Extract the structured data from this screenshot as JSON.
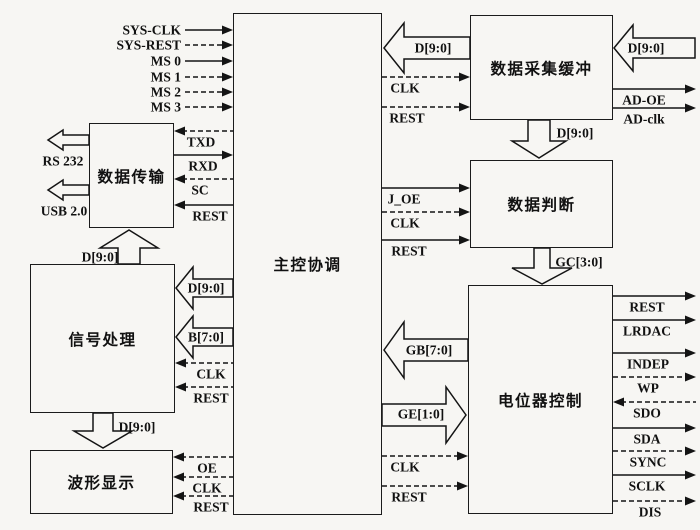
{
  "diagram": {
    "blocks": [
      {
        "id": "main-control",
        "label": "主控协调",
        "x": 233,
        "y": 13,
        "w": 149,
        "h": 502
      },
      {
        "id": "data-transfer",
        "label": "数据传输",
        "x": 89,
        "y": 123,
        "w": 85,
        "h": 105
      },
      {
        "id": "signal-processing",
        "label": "信号处理",
        "x": 30,
        "y": 264,
        "w": 145,
        "h": 149
      },
      {
        "id": "waveform-display",
        "label": "波形显示",
        "x": 30,
        "y": 450,
        "w": 143,
        "h": 64
      },
      {
        "id": "daq-buffer",
        "label": "数据采集缓冲",
        "x": 470,
        "y": 15,
        "w": 143,
        "h": 105
      },
      {
        "id": "data-judge",
        "label": "数据判断",
        "x": 470,
        "y": 160,
        "w": 143,
        "h": 88
      },
      {
        "id": "pot-control",
        "label": "电位器控制",
        "x": 468,
        "y": 285,
        "w": 145,
        "h": 229
      }
    ],
    "signals": [
      {
        "id": "sys-clk",
        "label": "SYS-CLK",
        "x1": 185,
        "x2": 233,
        "y": 30,
        "dash": false,
        "arrow": "right",
        "lx": 181,
        "ly": 30,
        "anchor": "end"
      },
      {
        "id": "sys-rest",
        "label": "SYS-REST",
        "x1": 185,
        "x2": 233,
        "y": 45,
        "dash": true,
        "arrow": "right",
        "lx": 181,
        "ly": 45,
        "anchor": "end"
      },
      {
        "id": "ms0",
        "label": "MS 0",
        "x1": 185,
        "x2": 233,
        "y": 61,
        "dash": false,
        "arrow": "right",
        "lx": 181,
        "ly": 61,
        "anchor": "end"
      },
      {
        "id": "ms1",
        "label": "MS 1",
        "x1": 185,
        "x2": 233,
        "y": 77,
        "dash": true,
        "arrow": "right",
        "lx": 181,
        "ly": 77,
        "anchor": "end"
      },
      {
        "id": "ms2",
        "label": "MS 2",
        "x1": 185,
        "x2": 233,
        "y": 92,
        "dash": true,
        "arrow": "right",
        "lx": 181,
        "ly": 92,
        "anchor": "end"
      },
      {
        "id": "ms3",
        "label": "MS 3",
        "x1": 185,
        "x2": 233,
        "y": 107,
        "dash": true,
        "arrow": "right",
        "lx": 181,
        "ly": 107,
        "anchor": "end"
      },
      {
        "id": "txd",
        "label": "TXD",
        "x1": 174,
        "x2": 233,
        "y": 131,
        "dash": true,
        "arrow": "left",
        "lx": 201,
        "ly": 142,
        "anchor": "mid"
      },
      {
        "id": "rxd",
        "label": "RXD",
        "x1": 174,
        "x2": 233,
        "y": 155,
        "dash": false,
        "arrow": "right",
        "lx": 203,
        "ly": 166,
        "anchor": "mid"
      },
      {
        "id": "sc",
        "label": "SC",
        "x1": 174,
        "x2": 233,
        "y": 179,
        "dash": true,
        "arrow": "left",
        "lx": 200,
        "ly": 190,
        "anchor": "mid"
      },
      {
        "id": "dt-rest",
        "label": "REST",
        "x1": 174,
        "x2": 233,
        "y": 205,
        "dash": false,
        "arrow": "left",
        "lx": 210,
        "ly": 216,
        "anchor": "mid"
      },
      {
        "id": "sp-clk",
        "label": "CLK",
        "x1": 175,
        "x2": 233,
        "y": 363,
        "dash": true,
        "arrow": "left",
        "lx": 211,
        "ly": 374,
        "anchor": "mid"
      },
      {
        "id": "sp-rest",
        "label": "REST",
        "x1": 175,
        "x2": 233,
        "y": 387,
        "dash": true,
        "arrow": "left",
        "lx": 211,
        "ly": 398,
        "anchor": "mid"
      },
      {
        "id": "wf-oe",
        "label": "OE",
        "x1": 173,
        "x2": 233,
        "y": 457,
        "dash": true,
        "arrow": "left",
        "lx": 207,
        "ly": 468,
        "anchor": "mid"
      },
      {
        "id": "wf-clk",
        "label": "CLK",
        "x1": 173,
        "x2": 233,
        "y": 477,
        "dash": true,
        "arrow": "left",
        "lx": 207,
        "ly": 488,
        "anchor": "mid"
      },
      {
        "id": "wf-rest",
        "label": "REST",
        "x1": 173,
        "x2": 233,
        "y": 496,
        "dash": true,
        "arrow": "left",
        "lx": 211,
        "ly": 507,
        "anchor": "mid"
      },
      {
        "id": "daq-clk",
        "label": "CLK",
        "x1": 382,
        "x2": 470,
        "y": 77,
        "dash": true,
        "arrow": "right",
        "lx": 405,
        "ly": 88,
        "anchor": "mid"
      },
      {
        "id": "daq-rest",
        "label": "REST",
        "x1": 382,
        "x2": 470,
        "y": 107,
        "dash": true,
        "arrow": "right",
        "lx": 407,
        "ly": 118,
        "anchor": "mid"
      },
      {
        "id": "judge-joe",
        "label": "J_OE",
        "x1": 382,
        "x2": 470,
        "y": 188,
        "dash": false,
        "arrow": "right",
        "lx": 404,
        "ly": 199,
        "anchor": "mid"
      },
      {
        "id": "judge-clk",
        "label": "CLK",
        "x1": 382,
        "x2": 470,
        "y": 212,
        "dash": true,
        "arrow": "right",
        "lx": 405,
        "ly": 223,
        "anchor": "mid"
      },
      {
        "id": "judge-rest",
        "label": "REST",
        "x1": 382,
        "x2": 470,
        "y": 240,
        "dash": false,
        "arrow": "right",
        "lx": 409,
        "ly": 251,
        "anchor": "mid"
      },
      {
        "id": "pot-clk",
        "label": "CLK",
        "x1": 382,
        "x2": 468,
        "y": 456,
        "dash": true,
        "arrow": "right",
        "lx": 405,
        "ly": 467,
        "anchor": "mid"
      },
      {
        "id": "pot-rest",
        "label": "REST",
        "x1": 382,
        "x2": 468,
        "y": 486,
        "dash": true,
        "arrow": "right",
        "lx": 409,
        "ly": 497,
        "anchor": "mid"
      },
      {
        "id": "ad-oe",
        "label": "AD-OE",
        "x1": 613,
        "x2": 696,
        "y": 89,
        "dash": false,
        "arrow": "right",
        "lx": 644,
        "ly": 100,
        "anchor": "mid"
      },
      {
        "id": "ad-clk",
        "label": "AD-clk",
        "x1": 613,
        "x2": 696,
        "y": 108,
        "dash": false,
        "arrow": "right",
        "lx": 644,
        "ly": 119,
        "anchor": "mid"
      },
      {
        "id": "pot-rest-out",
        "label": "REST",
        "x1": 613,
        "x2": 696,
        "y": 296,
        "dash": false,
        "arrow": "right",
        "lx": 647,
        "ly": 307,
        "anchor": "mid"
      },
      {
        "id": "pot-lrdac",
        "label": "LRDAC",
        "x1": 613,
        "x2": 696,
        "y": 320,
        "dash": false,
        "arrow": "right",
        "lx": 647,
        "ly": 331,
        "anchor": "mid"
      },
      {
        "id": "pot-indep",
        "label": "INDEP",
        "x1": 613,
        "x2": 696,
        "y": 353,
        "dash": false,
        "arrow": "right",
        "lx": 648,
        "ly": 364,
        "anchor": "mid"
      },
      {
        "id": "pot-wp",
        "label": "WP",
        "x1": 613,
        "x2": 696,
        "y": 377,
        "dash": true,
        "arrow": "right",
        "lx": 648,
        "ly": 388,
        "anchor": "mid"
      },
      {
        "id": "pot-sdo",
        "label": "SDO",
        "x1": 613,
        "x2": 696,
        "y": 402,
        "dash": true,
        "arrow": "left",
        "lx": 647,
        "ly": 413,
        "anchor": "mid"
      },
      {
        "id": "pot-sda",
        "label": "SDA",
        "x1": 613,
        "x2": 696,
        "y": 428,
        "dash": false,
        "arrow": "right",
        "lx": 647,
        "ly": 439,
        "anchor": "mid"
      },
      {
        "id": "pot-sync",
        "label": "SYNC",
        "x1": 613,
        "x2": 696,
        "y": 451,
        "dash": true,
        "arrow": "right",
        "lx": 648,
        "ly": 462,
        "anchor": "mid"
      },
      {
        "id": "pot-sclk",
        "label": "SCLK",
        "x1": 613,
        "x2": 696,
        "y": 475,
        "dash": false,
        "arrow": "right",
        "lx": 647,
        "ly": 486,
        "anchor": "mid"
      },
      {
        "id": "pot-dis",
        "label": "DIS",
        "x1": 613,
        "x2": 696,
        "y": 501,
        "dash": true,
        "arrow": "right",
        "lx": 650,
        "ly": 512,
        "anchor": "mid"
      }
    ],
    "hollow_arrows": [
      {
        "id": "rs232-out",
        "dir": "left",
        "tip": [
          48,
          140
        ],
        "head_len": 15,
        "half_head": 10,
        "half_shaft": 5,
        "shaft_len": 26,
        "label": "RS 232",
        "label_at": [
          63,
          161
        ]
      },
      {
        "id": "usb-out",
        "dir": "left",
        "tip": [
          48,
          190
        ],
        "head_len": 15,
        "half_head": 10,
        "half_shaft": 5,
        "shaft_len": 26,
        "label": "USB 2.0",
        "label_at": [
          64,
          211
        ]
      },
      {
        "id": "dt-d-up",
        "dir": "up",
        "tip": [
          129,
          230
        ],
        "head_len": 18,
        "half_head": 29,
        "half_shaft": 11,
        "shaft_len": 16,
        "label": "D[9:0]",
        "label_at": [
          100,
          257
        ]
      },
      {
        "id": "sp-d-in",
        "dir": "left",
        "tip": [
          176,
          288
        ],
        "head_len": 17,
        "half_head": 21,
        "half_shaft": 9,
        "shaft_len": 40,
        "label": "D[9:0]",
        "label_at": [
          206,
          288
        ]
      },
      {
        "id": "sp-b-in",
        "dir": "left",
        "tip": [
          176,
          337
        ],
        "head_len": 17,
        "half_head": 21,
        "half_shaft": 9,
        "shaft_len": 40,
        "label": "B[7:0]",
        "label_at": [
          206,
          337
        ]
      },
      {
        "id": "mc-d-in",
        "dir": "left",
        "tip": [
          384,
          48
        ],
        "head_len": 20,
        "half_head": 25,
        "half_shaft": 11,
        "shaft_len": 66,
        "label": "D[9:0]",
        "label_at": [
          433,
          48
        ]
      },
      {
        "id": "adc-d-in",
        "dir": "left",
        "tip": [
          614,
          48
        ],
        "head_len": 19,
        "half_head": 23,
        "half_shaft": 10,
        "shaft_len": 62,
        "label": "D[9:0]",
        "label_at": [
          646,
          48
        ]
      },
      {
        "id": "judge-d-down",
        "dir": "down",
        "tip": [
          539,
          158
        ],
        "head_len": 17,
        "half_head": 27,
        "half_shaft": 11,
        "shaft_len": 21,
        "label": "D[9:0]",
        "label_at": [
          575,
          133
        ]
      },
      {
        "id": "gc-down",
        "dir": "down",
        "tip": [
          542,
          284
        ],
        "head_len": 16,
        "half_head": 30,
        "half_shaft": 8,
        "shaft_len": 20,
        "label": "GC[3:0]",
        "label_at": [
          579,
          262
        ]
      },
      {
        "id": "gb-left",
        "dir": "left",
        "tip": [
          384,
          350
        ],
        "head_len": 20,
        "half_head": 28,
        "half_shaft": 11,
        "shaft_len": 64,
        "label": "GB[7:0]",
        "label_at": [
          429,
          350
        ]
      },
      {
        "id": "ge-right",
        "dir": "right",
        "tip": [
          466,
          415
        ],
        "head_len": 20,
        "half_head": 28,
        "half_shaft": 11,
        "shaft_len": 64,
        "label": "GE[1:0]",
        "label_at": [
          421,
          414
        ]
      },
      {
        "id": "wf-d-down",
        "dir": "down",
        "tip": [
          103,
          448
        ],
        "head_len": 17,
        "half_head": 29,
        "half_shaft": 10,
        "shaft_len": 18,
        "label": "D[9:0]",
        "label_at": [
          137,
          427
        ]
      }
    ]
  }
}
